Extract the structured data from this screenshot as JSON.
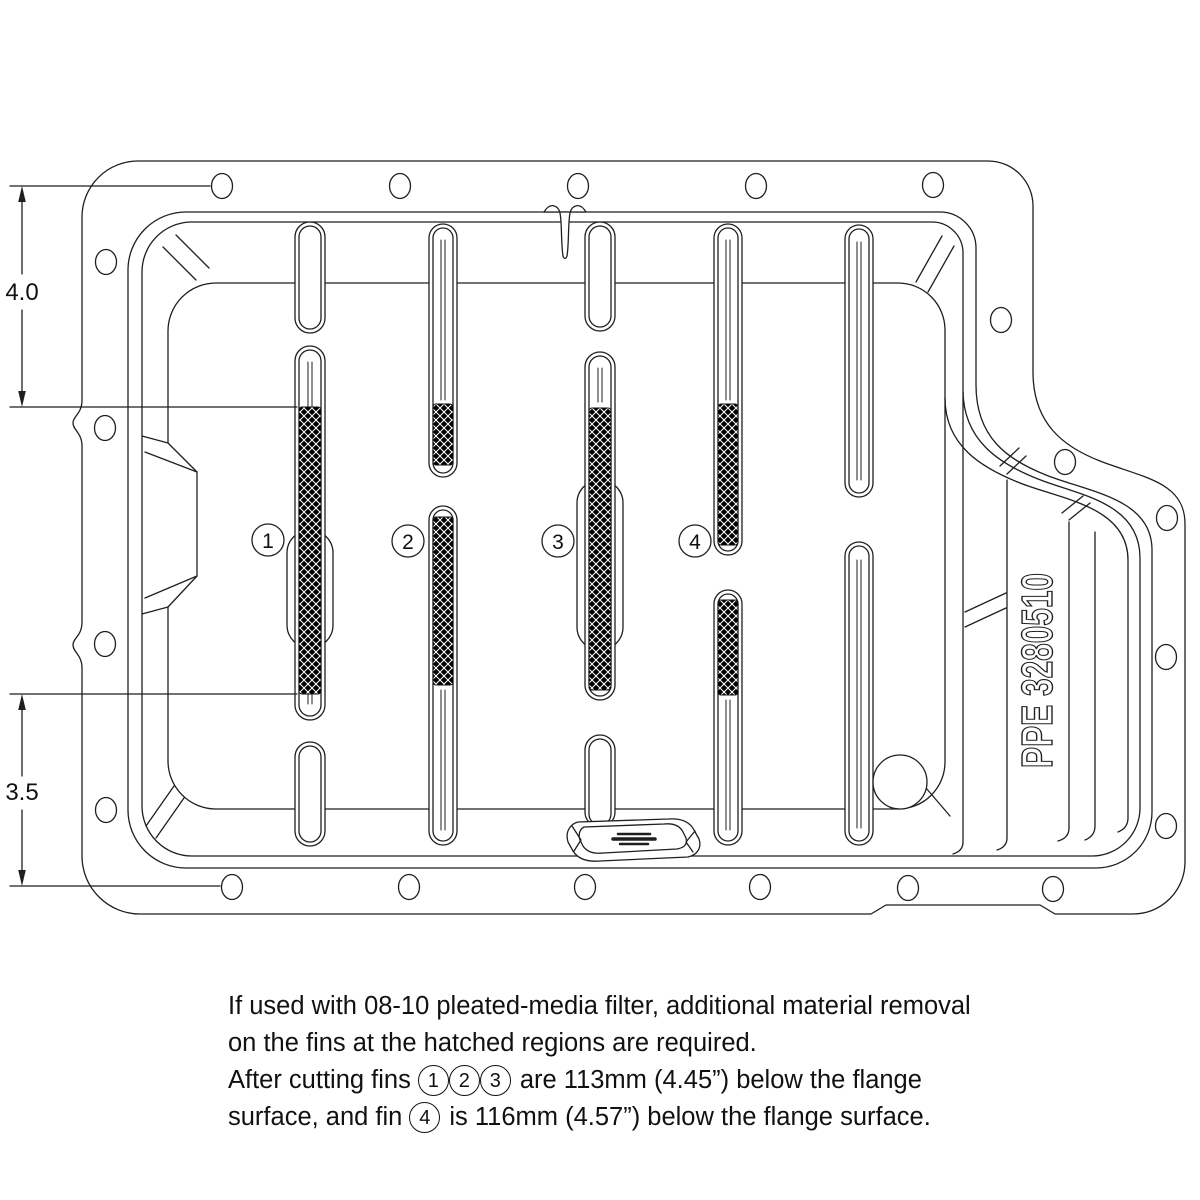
{
  "drawing": {
    "dim_top": "4.0",
    "dim_bottom": "3.5",
    "part_number": "PPE 3280510",
    "fin_callouts": {
      "f1": "1",
      "f2": "2",
      "f3": "3",
      "f4": "4"
    }
  },
  "notes": {
    "line1": "If used with 08-10 pleated-media filter, additional material removal",
    "line2": "on the fins at the hatched regions are required.",
    "line3_before": "After cutting fins",
    "line3_c1": "1",
    "line3_c2": "2",
    "line3_c3": "3",
    "line3_after": "are 113mm (4.45”) below the flange",
    "line4_before": "surface, and fin",
    "line4_c4": "4",
    "line4_after": "is 116mm (4.57”) below the flange surface."
  },
  "colors": {
    "line": "#1f1f1f",
    "background": "#ffffff",
    "hatch_bg": "#000000",
    "hatch_fg": "#ffffff"
  }
}
